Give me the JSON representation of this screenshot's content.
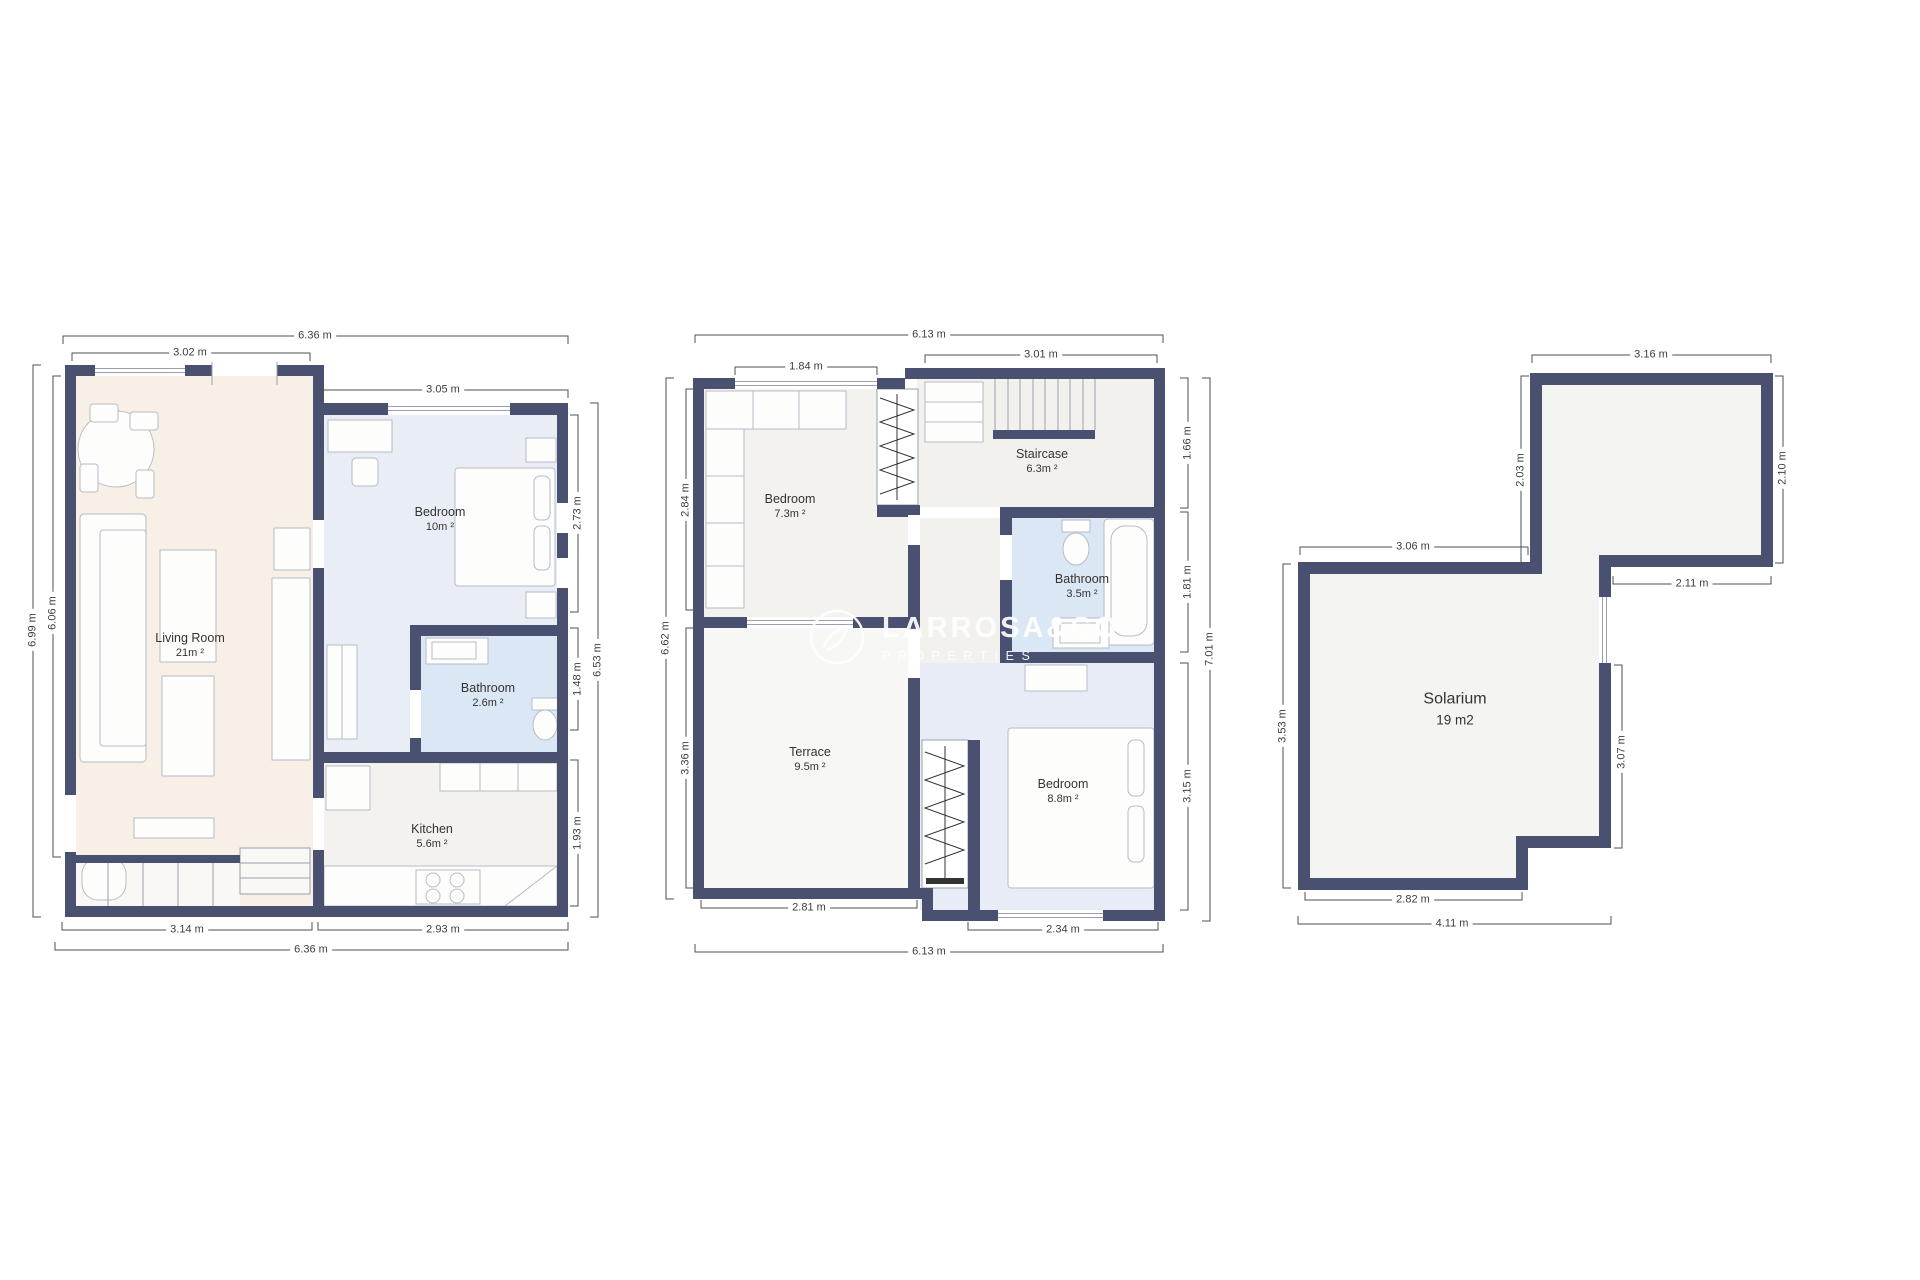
{
  "watermark": {
    "brand": "LARROSA&CO",
    "tagline": "PROPERTIES"
  },
  "plans": {
    "p1": {
      "rooms": {
        "living": {
          "name": "Living Room",
          "area": "21m ²"
        },
        "bedroom": {
          "name": "Bedroom",
          "area": "10m ²"
        },
        "bathroom": {
          "name": "Bathroom",
          "area": "2.6m ²"
        },
        "kitchen": {
          "name": "Kitchen",
          "area": "5.6m ²"
        }
      },
      "dims": {
        "top_outer": "6.36 m",
        "top_living": "3.02 m",
        "top_bedroom": "3.05 m",
        "left_outer": "6.99 m",
        "left_living": "6.06 m",
        "right_bedroom": "2.73 m",
        "right_bathroom": "1.48 m",
        "right_kitchen": "1.93 m",
        "right_outer": "6.53 m",
        "bottom_living": "3.14 m",
        "bottom_kitchen": "2.93 m",
        "bottom_outer": "6.36 m"
      }
    },
    "p2": {
      "rooms": {
        "bedroom1": {
          "name": "Bedroom",
          "area": "7.3m ²"
        },
        "staircase": {
          "name": "Staircase",
          "area": "6.3m ²"
        },
        "bathroom": {
          "name": "Bathroom",
          "area": "3.5m ²"
        },
        "terrace": {
          "name": "Terrace",
          "area": "9.5m ²"
        },
        "bedroom2": {
          "name": "Bedroom",
          "area": "8.8m ²"
        }
      },
      "dims": {
        "top_outer": "6.13 m",
        "top_bedroom": "1.84 m",
        "top_staircase": "3.01 m",
        "right_staircase": "1.66 m",
        "right_bathroom": "1.81 m",
        "right_bedroom": "3.15 m",
        "right_outer": "7.01 m",
        "left_bedroom": "2.84 m",
        "left_outer": "6.62 m",
        "left_terrace": "3.36 m",
        "bottom_terrace": "2.81 m",
        "bottom_bedroom": "2.34 m",
        "bottom_outer": "6.13 m"
      }
    },
    "p3": {
      "rooms": {
        "solarium": {
          "name": "Solarium",
          "area": "19 m2"
        }
      },
      "dims": {
        "top": "3.16 m",
        "upper_left": "2.03 m",
        "upper_right": "2.10 m",
        "main_top": "3.06 m",
        "inner_width": "2.11 m",
        "inner_height": "3.07 m",
        "left": "3.53 m",
        "bottom_inner": "2.82 m",
        "bottom_outer": "4.11 m"
      }
    }
  }
}
